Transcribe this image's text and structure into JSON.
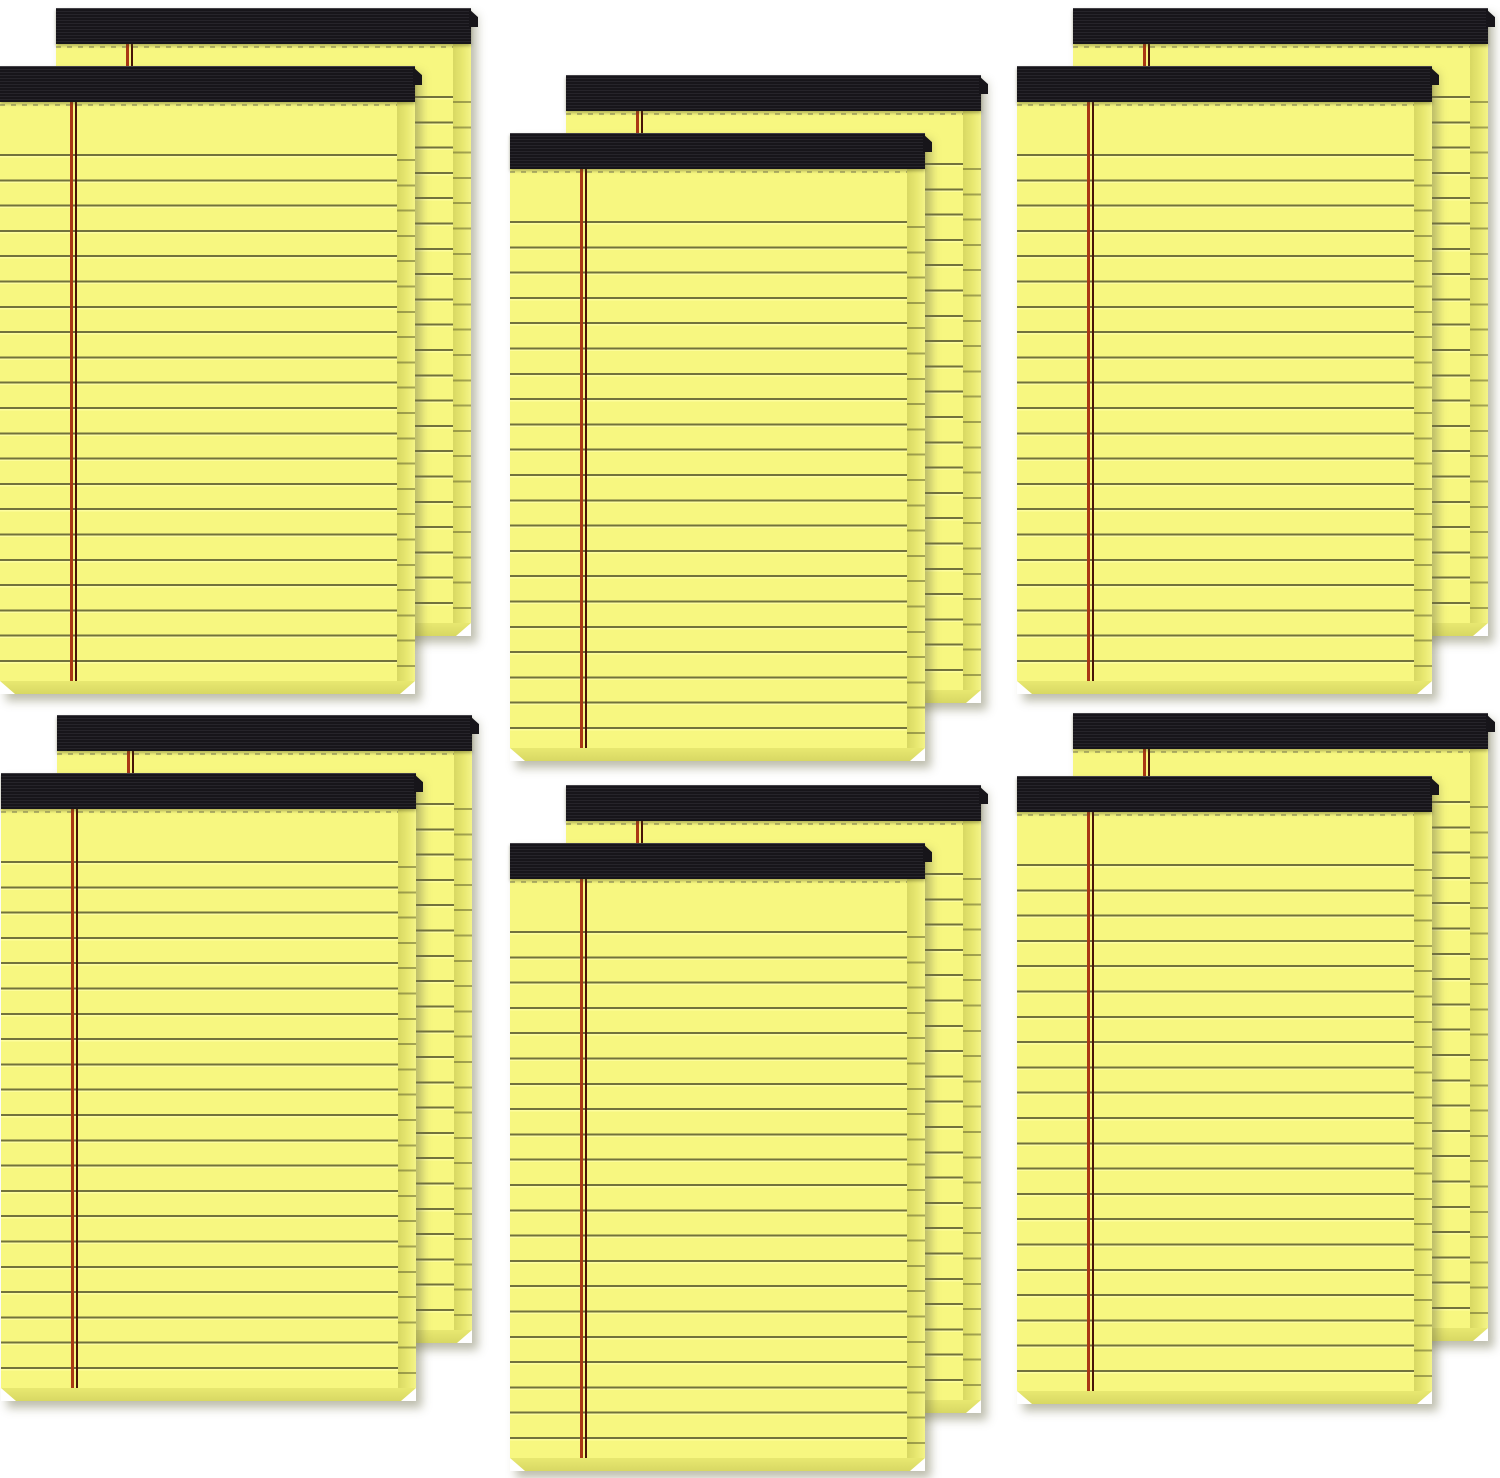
{
  "scene": {
    "description": "Product photo of 12 blank yellow legal note pads arranged as 6 overlapping pairs (3 columns x 2 rows) on a white background. Each pad has a black ribbed binding strip at the top, a dotted perforation line under the binding, olive ruled lines, a double red left margin line, and visible stacked-page edges on the right and bottom sides.",
    "pad_count": 12,
    "pair_count": 6,
    "grid": {
      "columns": 3,
      "rows": 2
    }
  },
  "colors": {
    "background": "#ffffff",
    "paper": "#f7f780",
    "rule_dark": "#72723c",
    "rule_light": "#fdfd9e",
    "margin_outer": "#a93714",
    "margin_inner": "#471407",
    "binding": "#17151a",
    "binding_rib": "#26242a",
    "edge_dark": "#d8d863",
    "edge_mid": "#e8e871",
    "edge_light": "#f4f488",
    "perforation": "#96965e",
    "shadow": "rgba(110,110,75,0.45)"
  },
  "pad": {
    "width": 415,
    "height": 628,
    "binding_height": 36,
    "edge_width": 18,
    "bottom_edge_height": 13,
    "rule_spacing": 25.3,
    "first_rule_offset": 52,
    "margin_line_x": 70
  },
  "groups": [
    {
      "id": "top-left",
      "back": {
        "x": 56,
        "y": 8
      },
      "front": {
        "x": 0,
        "y": 66
      }
    },
    {
      "id": "top-center",
      "back": {
        "x": 566,
        "y": 75
      },
      "front": {
        "x": 510,
        "y": 133
      }
    },
    {
      "id": "top-right",
      "back": {
        "x": 1073,
        "y": 8
      },
      "front": {
        "x": 1017,
        "y": 66
      }
    },
    {
      "id": "bottom-left",
      "back": {
        "x": 57,
        "y": 715
      },
      "front": {
        "x": 1,
        "y": 773
      }
    },
    {
      "id": "bottom-center",
      "back": {
        "x": 566,
        "y": 785
      },
      "front": {
        "x": 510,
        "y": 843
      }
    },
    {
      "id": "bottom-right",
      "back": {
        "x": 1073,
        "y": 713
      },
      "front": {
        "x": 1017,
        "y": 776
      }
    }
  ]
}
